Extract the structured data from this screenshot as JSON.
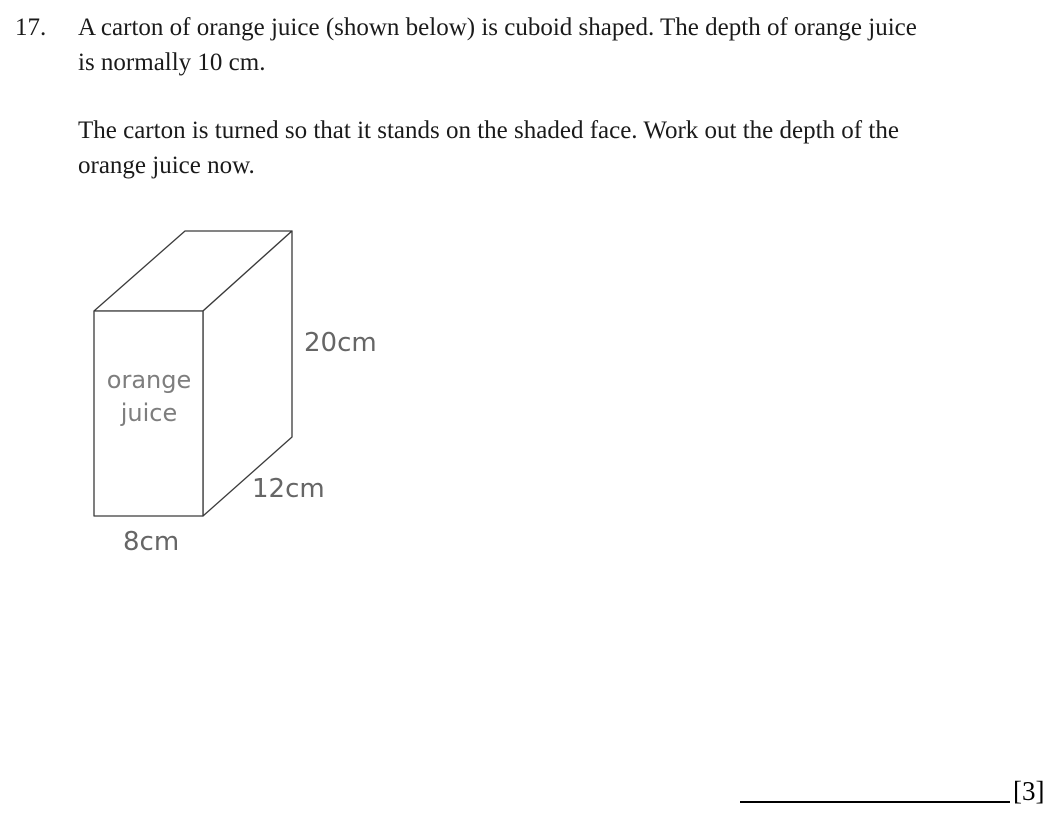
{
  "question": {
    "number": "17.",
    "paragraph1_lines": [
      "A carton of orange juice (shown below) is cuboid shaped. The depth of orange juice",
      "is normally 10 cm."
    ],
    "paragraph2_lines": [
      "The carton is turned so that it stands on the shaded face. Work out the depth of the",
      "orange juice now."
    ]
  },
  "diagram": {
    "face_label_line1": "orange",
    "face_label_line2": "juice",
    "height_label": "20cm",
    "depth_label": "12cm",
    "width_label": "8cm",
    "shaded_face_color": "#c8c8c8",
    "plain_face_color": "#ffffff",
    "outline_color": "#3a3a3a",
    "dimension_label_color": "#666666"
  },
  "answer": {
    "marks_label": "[3]"
  }
}
